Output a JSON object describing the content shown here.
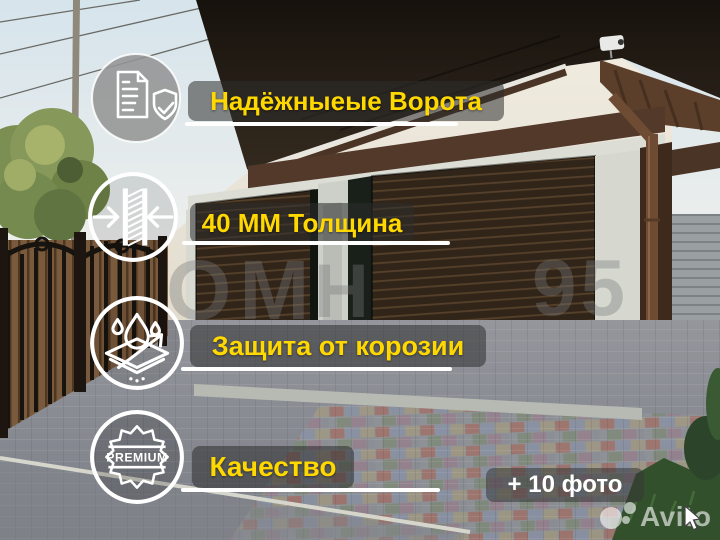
{
  "features": [
    {
      "label": "Надёжныеые Ворота",
      "icon": "document-shield-check-icon"
    },
    {
      "label": "40 ММ Толщина",
      "icon": "panel-thickness-arrows-icon"
    },
    {
      "label": "Защита от корозии",
      "icon": "corrosion-protection-drops-icon"
    },
    {
      "label": "Качество",
      "icon": "premium-badge-icon",
      "badge_text": "PREMIUM"
    }
  ],
  "photo_count": {
    "label": "+ 10 фото"
  },
  "branding": {
    "watermark": "Avito"
  },
  "photo_watermark": {
    "part1": "ОМ",
    "part2": "Н",
    "part3": "95"
  },
  "colors": {
    "accent_yellow": "#FFD800",
    "band_background": "rgba(45,45,45,0.55)",
    "underline_white": "#FFFFFF",
    "door_brown": "#31251a",
    "trim_brown": "#53392a"
  }
}
